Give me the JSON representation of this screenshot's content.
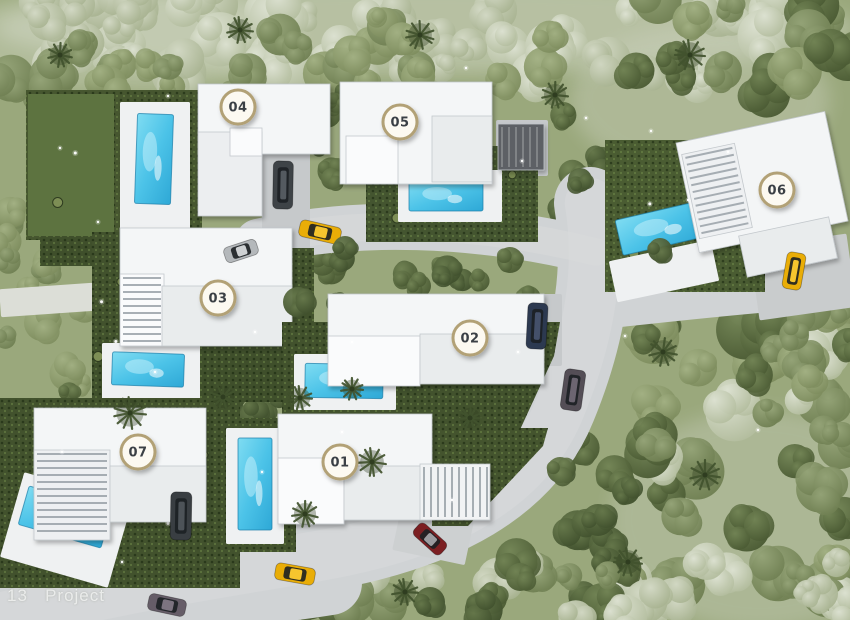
{
  "watermark": {
    "text": "13   Project"
  },
  "badge_style": {
    "fill": "#fcf9f1",
    "border": "#b2a176",
    "text_color": "#3b3f45",
    "radius": 17
  },
  "palette": {
    "ground": "#9aa87c",
    "road": "#d0d3d5",
    "road_light": "#d9dbdc",
    "driveway": "#c6c9cb",
    "pale_band": "#dcded7",
    "hedge_dark": "#3f4f2b",
    "lawn": "#5d7340",
    "deck": "#eff1f2",
    "pool_deep": "#2ea8d6",
    "pool_light": "#7fdcf2"
  },
  "roads": {
    "main_path": "M 590 203 C 600 265 592 330 560 408 C 528 487 446 534 318 556 C 214 574 118 588 8 616",
    "main_width": 72,
    "top_path": "M 258 242 C 352 219 476 222 596 252",
    "top_width": 46,
    "right_path": "M 582 314 C 660 306 726 298 806 292",
    "right_width": 34,
    "bottom_path": "M 330 583 C 226 600 104 602 0 586",
    "bottom_width": 64
  },
  "driveways": [
    {
      "x": 262,
      "y": 150,
      "w": 48,
      "h": 116,
      "rot": 0,
      "fill": "#c6c9cb"
    },
    {
      "x": 220,
      "y": 238,
      "w": 72,
      "h": 32,
      "rot": -8,
      "fill": "#cbced0"
    },
    {
      "x": 496,
      "y": 120,
      "w": 52,
      "h": 56,
      "rot": 0,
      "fill": "#c6c9cb"
    },
    {
      "x": 754,
      "y": 240,
      "w": 98,
      "h": 74,
      "rot": -8,
      "fill": "#c9cccd"
    },
    {
      "x": 506,
      "y": 294,
      "w": 56,
      "h": 72,
      "rot": 0,
      "fill": "#c6c9cb"
    },
    {
      "x": 152,
      "y": 478,
      "w": 64,
      "h": 86,
      "rot": 0,
      "fill": "#c6c9cb"
    },
    {
      "x": 396,
      "y": 514,
      "w": 74,
      "h": 44,
      "rot": 12,
      "fill": "#cdd0d1"
    },
    {
      "x": 0,
      "y": 286,
      "w": 94,
      "h": 28,
      "rot": -4,
      "fill": "#dcded7"
    }
  ],
  "villas": [
    {
      "label": "04",
      "badge": {
        "x": 238,
        "y": 107
      },
      "hedges": [
        {
          "x": 26,
          "y": 90,
          "w": 176,
          "h": 150,
          "fill": "#46562f"
        },
        {
          "x": 40,
          "y": 236,
          "w": 172,
          "h": 30,
          "fill": "#3f4f2b"
        }
      ],
      "lawns": [
        {
          "x": 28,
          "y": 94,
          "w": 86,
          "h": 142,
          "fill": "#5d7340"
        }
      ],
      "decks": [
        {
          "x": 120,
          "y": 102,
          "w": 70,
          "h": 132
        }
      ],
      "pool": {
        "x": 136,
        "y": 114,
        "w": 36,
        "h": 90,
        "rot": 2
      },
      "roofs": [
        {
          "x": 198,
          "y": 84,
          "w": 132,
          "h": 70,
          "fill": "#f4f6f7"
        },
        {
          "x": 198,
          "y": 132,
          "w": 64,
          "h": 84,
          "fill": "#eceef0"
        },
        {
          "x": 230,
          "y": 128,
          "w": 32,
          "h": 28,
          "fill": "#fafbfc"
        }
      ]
    },
    {
      "label": "05",
      "badge": {
        "x": 400,
        "y": 122
      },
      "hedges": [
        {
          "x": 366,
          "y": 146,
          "w": 172,
          "h": 96,
          "fill": "#445530"
        }
      ],
      "lawns": [],
      "decks": [
        {
          "x": 398,
          "y": 170,
          "w": 104,
          "h": 52
        }
      ],
      "pool": {
        "x": 409,
        "y": 181,
        "w": 74,
        "h": 30,
        "rot": 0
      },
      "roofs": [
        {
          "x": 340,
          "y": 82,
          "w": 152,
          "h": 102,
          "fill": "#f4f6f7"
        },
        {
          "x": 346,
          "y": 136,
          "w": 52,
          "h": 48,
          "fill": "#fafbfc"
        },
        {
          "x": 432,
          "y": 116,
          "w": 60,
          "h": 66,
          "fill": "#e9eced"
        },
        {
          "x": 498,
          "y": 124,
          "w": 46,
          "h": 46,
          "fill": "#5d6165",
          "slats": "v",
          "slat_color": "rgba(255,255,255,.22)"
        }
      ]
    },
    {
      "label": "06",
      "badge": {
        "x": 777,
        "y": 190
      },
      "hedges": [
        {
          "x": 605,
          "y": 140,
          "w": 160,
          "h": 152,
          "fill": "#4a5c32"
        }
      ],
      "lawns": [],
      "decks": [
        {
          "x": 612,
          "y": 250,
          "w": 104,
          "h": 42,
          "rot": -12
        }
      ],
      "pool": {
        "x": 618,
        "y": 210,
        "w": 88,
        "h": 36,
        "rot": -13
      },
      "roofs": [
        {
          "x": 686,
          "y": 126,
          "w": 152,
          "h": 112,
          "fill": "#f3f5f6",
          "rot": -12
        },
        {
          "x": 690,
          "y": 148,
          "w": 54,
          "h": 86,
          "fill": "#eef0f2",
          "rot": -12,
          "slats": "h"
        },
        {
          "x": 742,
          "y": 226,
          "w": 92,
          "h": 42,
          "fill": "#e9eced",
          "rot": -12
        }
      ]
    },
    {
      "label": "03",
      "badge": {
        "x": 218,
        "y": 298
      },
      "hedges": [
        {
          "x": 92,
          "y": 232,
          "w": 34,
          "h": 166,
          "fill": "#42522d"
        },
        {
          "x": 95,
          "y": 338,
          "w": 218,
          "h": 64,
          "fill": "#3f4f2b"
        },
        {
          "x": 288,
          "y": 248,
          "w": 26,
          "h": 152,
          "fill": "#42522d"
        }
      ],
      "lawns": [],
      "decks": [
        {
          "x": 102,
          "y": 343,
          "w": 98,
          "h": 57
        }
      ],
      "pool": {
        "x": 112,
        "y": 353,
        "w": 72,
        "h": 33,
        "rot": 2
      },
      "roofs": [
        {
          "x": 120,
          "y": 228,
          "w": 172,
          "h": 86,
          "fill": "#f4f6f7"
        },
        {
          "x": 120,
          "y": 274,
          "w": 44,
          "h": 72,
          "fill": "#fafbfc",
          "slats": "h"
        },
        {
          "x": 162,
          "y": 286,
          "w": 130,
          "h": 60,
          "fill": "#e9eced"
        }
      ]
    },
    {
      "label": "02",
      "badge": {
        "x": 470,
        "y": 338
      },
      "hedges": [
        {
          "pts": "282,322 560,322 554,356 518,434 282,434",
          "fill": "#42522d"
        }
      ],
      "lawns": [],
      "decks": [
        {
          "x": 294,
          "y": 354,
          "w": 102,
          "h": 56
        }
      ],
      "pool": {
        "x": 305,
        "y": 364,
        "w": 78,
        "h": 34,
        "rot": 1
      },
      "roofs": [
        {
          "x": 328,
          "y": 294,
          "w": 216,
          "h": 64,
          "fill": "#f4f6f7"
        },
        {
          "x": 328,
          "y": 336,
          "w": 92,
          "h": 50,
          "fill": "#fafbfc"
        },
        {
          "x": 420,
          "y": 334,
          "w": 124,
          "h": 50,
          "fill": "#e9eced"
        }
      ]
    },
    {
      "label": "07",
      "badge": {
        "x": 138,
        "y": 452
      },
      "hedges": [
        {
          "x": 0,
          "y": 398,
          "w": 240,
          "h": 190,
          "fill": "#42522d"
        }
      ],
      "lawns": [],
      "decks": [
        {
          "x": 10,
          "y": 486,
          "w": 112,
          "h": 88,
          "rot": 16
        }
      ],
      "pool": {
        "x": 22,
        "y": 497,
        "w": 86,
        "h": 40,
        "rot": 16
      },
      "roofs": [
        {
          "x": 34,
          "y": 408,
          "w": 172,
          "h": 84,
          "fill": "#f4f6f7"
        },
        {
          "x": 34,
          "y": 450,
          "w": 76,
          "h": 90,
          "fill": "#eef0f2",
          "slats": "h"
        },
        {
          "x": 110,
          "y": 466,
          "w": 96,
          "h": 56,
          "fill": "#e9eced"
        }
      ]
    },
    {
      "label": "01",
      "badge": {
        "x": 340,
        "y": 462
      },
      "hedges": [
        {
          "x": 222,
          "y": 418,
          "w": 74,
          "h": 134,
          "fill": "#42522d"
        },
        {
          "pts": "432,428 548,428 543,446 468,526 432,526",
          "fill": "#44542e"
        }
      ],
      "lawns": [],
      "decks": [
        {
          "x": 226,
          "y": 428,
          "w": 58,
          "h": 116
        }
      ],
      "pool": {
        "x": 238,
        "y": 438,
        "w": 34,
        "h": 92,
        "rot": 0
      },
      "roofs": [
        {
          "x": 278,
          "y": 414,
          "w": 154,
          "h": 76,
          "fill": "#f4f6f7"
        },
        {
          "x": 278,
          "y": 458,
          "w": 66,
          "h": 66,
          "fill": "#fafbfc"
        },
        {
          "x": 344,
          "y": 466,
          "w": 90,
          "h": 54,
          "fill": "#e9eced"
        },
        {
          "x": 420,
          "y": 464,
          "w": 70,
          "h": 56,
          "fill": "#f1f3f4",
          "slats": "v"
        }
      ]
    }
  ],
  "cars": [
    {
      "name": "car-gold-road-mid",
      "x": 320,
      "y": 232,
      "w": 42,
      "h": 17,
      "rot": 13,
      "color": "#e9ad07",
      "roof": "#f6c52e"
    },
    {
      "name": "car-dark-villa04",
      "x": 283,
      "y": 185,
      "w": 20,
      "h": 48,
      "rot": 1,
      "color": "#3e4347",
      "roof": "#545a60"
    },
    {
      "name": "car-silver-villa04",
      "x": 241,
      "y": 251,
      "w": 34,
      "h": 16,
      "rot": -18,
      "color": "#b4b8bb",
      "roof": "#ced1d3"
    },
    {
      "name": "car-navy-villa02",
      "x": 537,
      "y": 326,
      "w": 20,
      "h": 46,
      "rot": 3,
      "color": "#2c3950",
      "roof": "#44506a"
    },
    {
      "name": "car-gray-road",
      "x": 573,
      "y": 390,
      "w": 21,
      "h": 41,
      "rot": 8,
      "color": "#544e56",
      "roof": "#6c6571"
    },
    {
      "name": "car-gold-villa06",
      "x": 794,
      "y": 271,
      "w": 19,
      "h": 37,
      "rot": 10,
      "color": "#e9ad07",
      "roof": "#f6c52e"
    },
    {
      "name": "car-dark-villa07",
      "x": 181,
      "y": 516,
      "w": 21,
      "h": 48,
      "rot": 1,
      "color": "#393e42",
      "roof": "#4d5358"
    },
    {
      "name": "car-red-road",
      "x": 430,
      "y": 539,
      "w": 36,
      "h": 16,
      "rot": 42,
      "color": "#7c1f22",
      "roof": "#9b9ca0"
    },
    {
      "name": "car-gold-road-bottom",
      "x": 295,
      "y": 574,
      "w": 40,
      "h": 17,
      "rot": 10,
      "color": "#e9ad07",
      "roof": "#f6c52e"
    },
    {
      "name": "car-gray-road-bottom",
      "x": 167,
      "y": 605,
      "w": 38,
      "h": 17,
      "rot": 12,
      "color": "#665d68",
      "roof": "#7d7480"
    }
  ],
  "vegetation": {
    "zones": [
      {
        "x": 0,
        "y": 0,
        "w": 850,
        "h": 78,
        "n": 55,
        "palette": "pale",
        "rmin": 13,
        "rmax": 28
      },
      {
        "x": 0,
        "y": 34,
        "w": 340,
        "h": 76,
        "n": 16,
        "palette": "olive",
        "rmin": 12,
        "rmax": 24
      },
      {
        "x": 340,
        "y": 22,
        "w": 260,
        "h": 66,
        "n": 12,
        "palette": "olive",
        "rmin": 12,
        "rmax": 22
      },
      {
        "x": 600,
        "y": 0,
        "w": 250,
        "h": 120,
        "n": 16,
        "palette": "mix",
        "rmin": 12,
        "rmax": 26
      },
      {
        "x": 552,
        "y": 100,
        "w": 56,
        "h": 220,
        "n": 10,
        "palette": "dark",
        "rmin": 10,
        "rmax": 18
      },
      {
        "x": 620,
        "y": 300,
        "w": 230,
        "h": 310,
        "n": 42,
        "palette": "mix",
        "rmin": 14,
        "rmax": 30
      },
      {
        "x": 560,
        "y": 420,
        "w": 90,
        "h": 200,
        "n": 14,
        "palette": "dark",
        "rmin": 10,
        "rmax": 20
      },
      {
        "x": 760,
        "y": 300,
        "w": 90,
        "h": 140,
        "n": 10,
        "palette": "olive",
        "rmin": 12,
        "rmax": 22
      },
      {
        "x": 0,
        "y": 200,
        "w": 95,
        "h": 200,
        "n": 14,
        "palette": "olive",
        "rmin": 10,
        "rmax": 20
      },
      {
        "x": 60,
        "y": 378,
        "w": 500,
        "h": 50,
        "n": 24,
        "palette": "dark",
        "rmin": 9,
        "rmax": 16
      },
      {
        "x": 295,
        "y": 246,
        "w": 265,
        "h": 80,
        "n": 16,
        "palette": "dark",
        "rmin": 9,
        "rmax": 15
      },
      {
        "x": 205,
        "y": 556,
        "w": 420,
        "h": 64,
        "n": 22,
        "palette": "mixdark",
        "rmin": 11,
        "rmax": 22
      },
      {
        "x": 620,
        "y": 560,
        "w": 230,
        "h": 60,
        "n": 10,
        "palette": "pale",
        "rmin": 12,
        "rmax": 24
      },
      {
        "x": 318,
        "y": 88,
        "w": 30,
        "h": 104,
        "n": 6,
        "palette": "dark",
        "rmin": 8,
        "rmax": 14
      }
    ],
    "palms": [
      {
        "x": 130,
        "y": 413,
        "r": 16
      },
      {
        "x": 223,
        "y": 397,
        "r": 13
      },
      {
        "x": 300,
        "y": 398,
        "r": 12
      },
      {
        "x": 372,
        "y": 462,
        "r": 14
      },
      {
        "x": 305,
        "y": 514,
        "r": 13
      },
      {
        "x": 352,
        "y": 389,
        "r": 11
      },
      {
        "x": 470,
        "y": 418,
        "r": 12
      },
      {
        "x": 663,
        "y": 352,
        "r": 14
      },
      {
        "x": 705,
        "y": 475,
        "r": 15
      },
      {
        "x": 628,
        "y": 562,
        "r": 14
      },
      {
        "x": 405,
        "y": 592,
        "r": 13
      },
      {
        "x": 555,
        "y": 95,
        "r": 13
      },
      {
        "x": 690,
        "y": 55,
        "r": 15
      },
      {
        "x": 420,
        "y": 35,
        "r": 14
      },
      {
        "x": 240,
        "y": 30,
        "r": 13
      },
      {
        "x": 60,
        "y": 55,
        "r": 12
      }
    ],
    "clumps": [
      {
        "x": 298,
        "y": 302,
        "r": 15
      },
      {
        "x": 560,
        "y": 470,
        "r": 13
      },
      {
        "x": 598,
        "y": 520,
        "r": 16
      },
      {
        "x": 430,
        "y": 602,
        "r": 15
      },
      {
        "x": 520,
        "y": 577,
        "r": 14
      },
      {
        "x": 660,
        "y": 250,
        "r": 12
      },
      {
        "x": 580,
        "y": 180,
        "r": 12
      },
      {
        "x": 345,
        "y": 248,
        "r": 12
      },
      {
        "x": 510,
        "y": 260,
        "r": 13
      }
    ],
    "sparkles": [
      [
        466,
        68
      ],
      [
        522,
        161
      ],
      [
        586,
        118
      ],
      [
        651,
        131
      ],
      [
        728,
        152
      ],
      [
        625,
        336
      ],
      [
        60,
        148
      ],
      [
        98,
        222
      ],
      [
        155,
        372
      ],
      [
        255,
        332
      ],
      [
        352,
        342
      ],
      [
        518,
        352
      ],
      [
        62,
        452
      ],
      [
        122,
        562
      ],
      [
        262,
        472
      ],
      [
        452,
        500
      ],
      [
        342,
        432
      ],
      [
        688,
        200
      ],
      [
        758,
        430
      ],
      [
        168,
        96
      ]
    ]
  }
}
